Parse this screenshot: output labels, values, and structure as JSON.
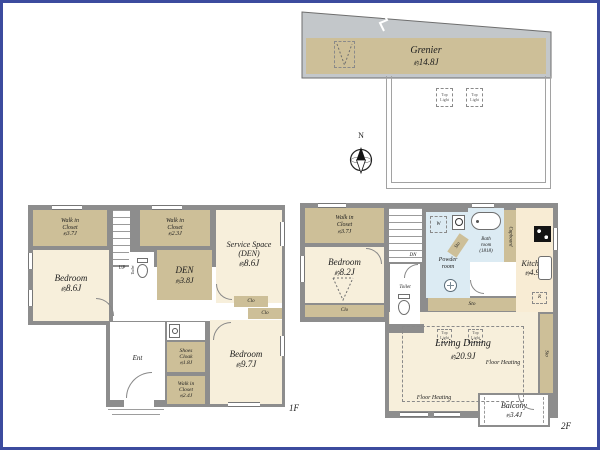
{
  "frame_color": "#3c4b9e",
  "palette": {
    "wall": "#8d8d8d",
    "room": "#f7efdb",
    "closet": "#cdbf98",
    "wet": "#dcebf3",
    "kitchen": "#f8ecd4",
    "roof": "#c3c7ca"
  },
  "compass": {
    "n": "N"
  },
  "grenier": {
    "name": "Grenier",
    "size": "約14.8J",
    "top_lights": [
      "Top\nLight",
      "Top\nLight"
    ]
  },
  "f1": {
    "floor_label": "1F",
    "up": "UP",
    "wic_nw": {
      "name": "Walk in\nCloset",
      "size": "約3.7J"
    },
    "bedroom_w": {
      "name": "Bedroom",
      "size": "約8.6J"
    },
    "wic_n": {
      "name": "Walk in\nCloset",
      "size": "約2.3J"
    },
    "den": {
      "name": "DEN",
      "size": "約3.8J"
    },
    "service": {
      "name": "Service Space\n(DEN)",
      "size": "約8.6J"
    },
    "toilet": "Toilet",
    "clo_a": "Clo",
    "clo_b": "Clo",
    "ent": "Ent",
    "shoes": {
      "name": "Shoes\nCloak",
      "size": "約1.8J"
    },
    "wic_s": {
      "name": "Walk in\nCloset",
      "size": "約2.4J"
    },
    "bedroom_s": {
      "name": "Bedroom",
      "size": "約9.7J"
    }
  },
  "f2": {
    "floor_label": "2F",
    "dn": "DN",
    "wic": {
      "name": "Walk in\nCloset",
      "size": "約3.7J"
    },
    "bedroom": {
      "name": "Bedroom",
      "size": "約8.2J"
    },
    "clo": "Clo",
    "toilet": "Toilet",
    "powder": {
      "name": "Powder\nroom"
    },
    "washer": "W",
    "fridge": "R",
    "sto_diag": "Sto",
    "sto_h": "Sto",
    "sto_v": "Sto",
    "bath": {
      "name": "Bath\nroom\n(1818)"
    },
    "cupboard": "Cupboard",
    "kitchen": {
      "name": "Kitchen",
      "size": "約4.9J"
    },
    "living": {
      "name": "Living Dining",
      "size": "約20.9J",
      "floor_heating": "Floor Heating",
      "top_lights": [
        "Top\nLight",
        "Top\nLight"
      ]
    },
    "balcony": {
      "name": "Balcony",
      "size": "約3.4J"
    }
  }
}
